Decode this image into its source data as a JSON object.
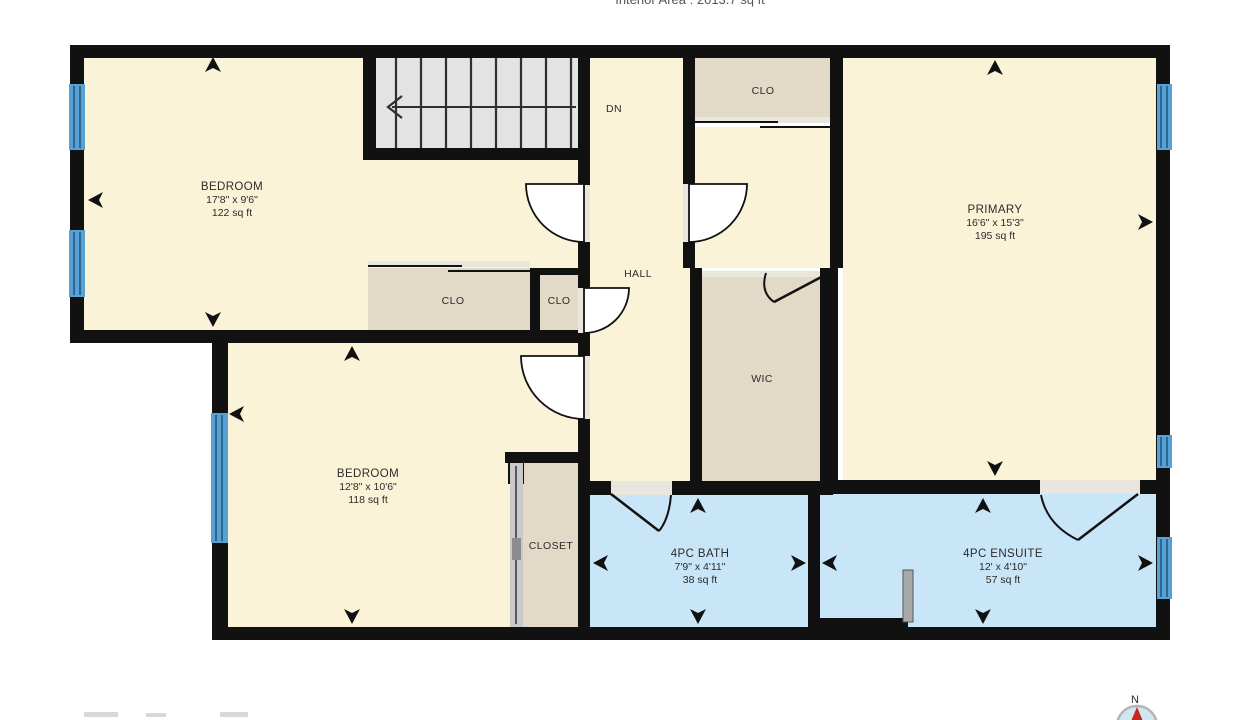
{
  "header": {
    "title": "Interior Area : 2013.7 sq ft"
  },
  "colors": {
    "wall": "#111111",
    "room_fill": "#fbf3d8",
    "closet_fill": "#e2dac6",
    "bath_fill": "#c9e6f8",
    "window_fill": "#57a1d4",
    "stairs_fill": "#e3e3e3",
    "arrow": "#111111",
    "threshold": "#e9e6de",
    "compass_needle": "#c4271d"
  },
  "rooms": {
    "bedroom1": {
      "name": "BEDROOM",
      "dims": "17'8\" x 9'6\"",
      "area": "122 sq ft"
    },
    "bedroom2": {
      "name": "BEDROOM",
      "dims": "12'8\" x 10'6\"",
      "area": "118 sq ft"
    },
    "primary": {
      "name": "PRIMARY",
      "dims": "16'6\" x 15'3\"",
      "area": "195 sq ft"
    },
    "bath": {
      "name": "4PC BATH",
      "dims": "7'9\" x 4'11\"",
      "area": "38 sq ft"
    },
    "ensuite": {
      "name": "4PC ENSUITE",
      "dims": "12' x 4'10\"",
      "area": "57 sq ft"
    },
    "hall": {
      "name": "HALL"
    },
    "wic": {
      "name": "WIC"
    },
    "closet": {
      "name": "CLOSET"
    },
    "clo_top": {
      "name": "CLO"
    },
    "clo_left": {
      "name": "CLO"
    },
    "clo_mid": {
      "name": "CLO"
    },
    "stairs": {
      "label": "DN"
    }
  },
  "compass": {
    "north_label": "N"
  }
}
